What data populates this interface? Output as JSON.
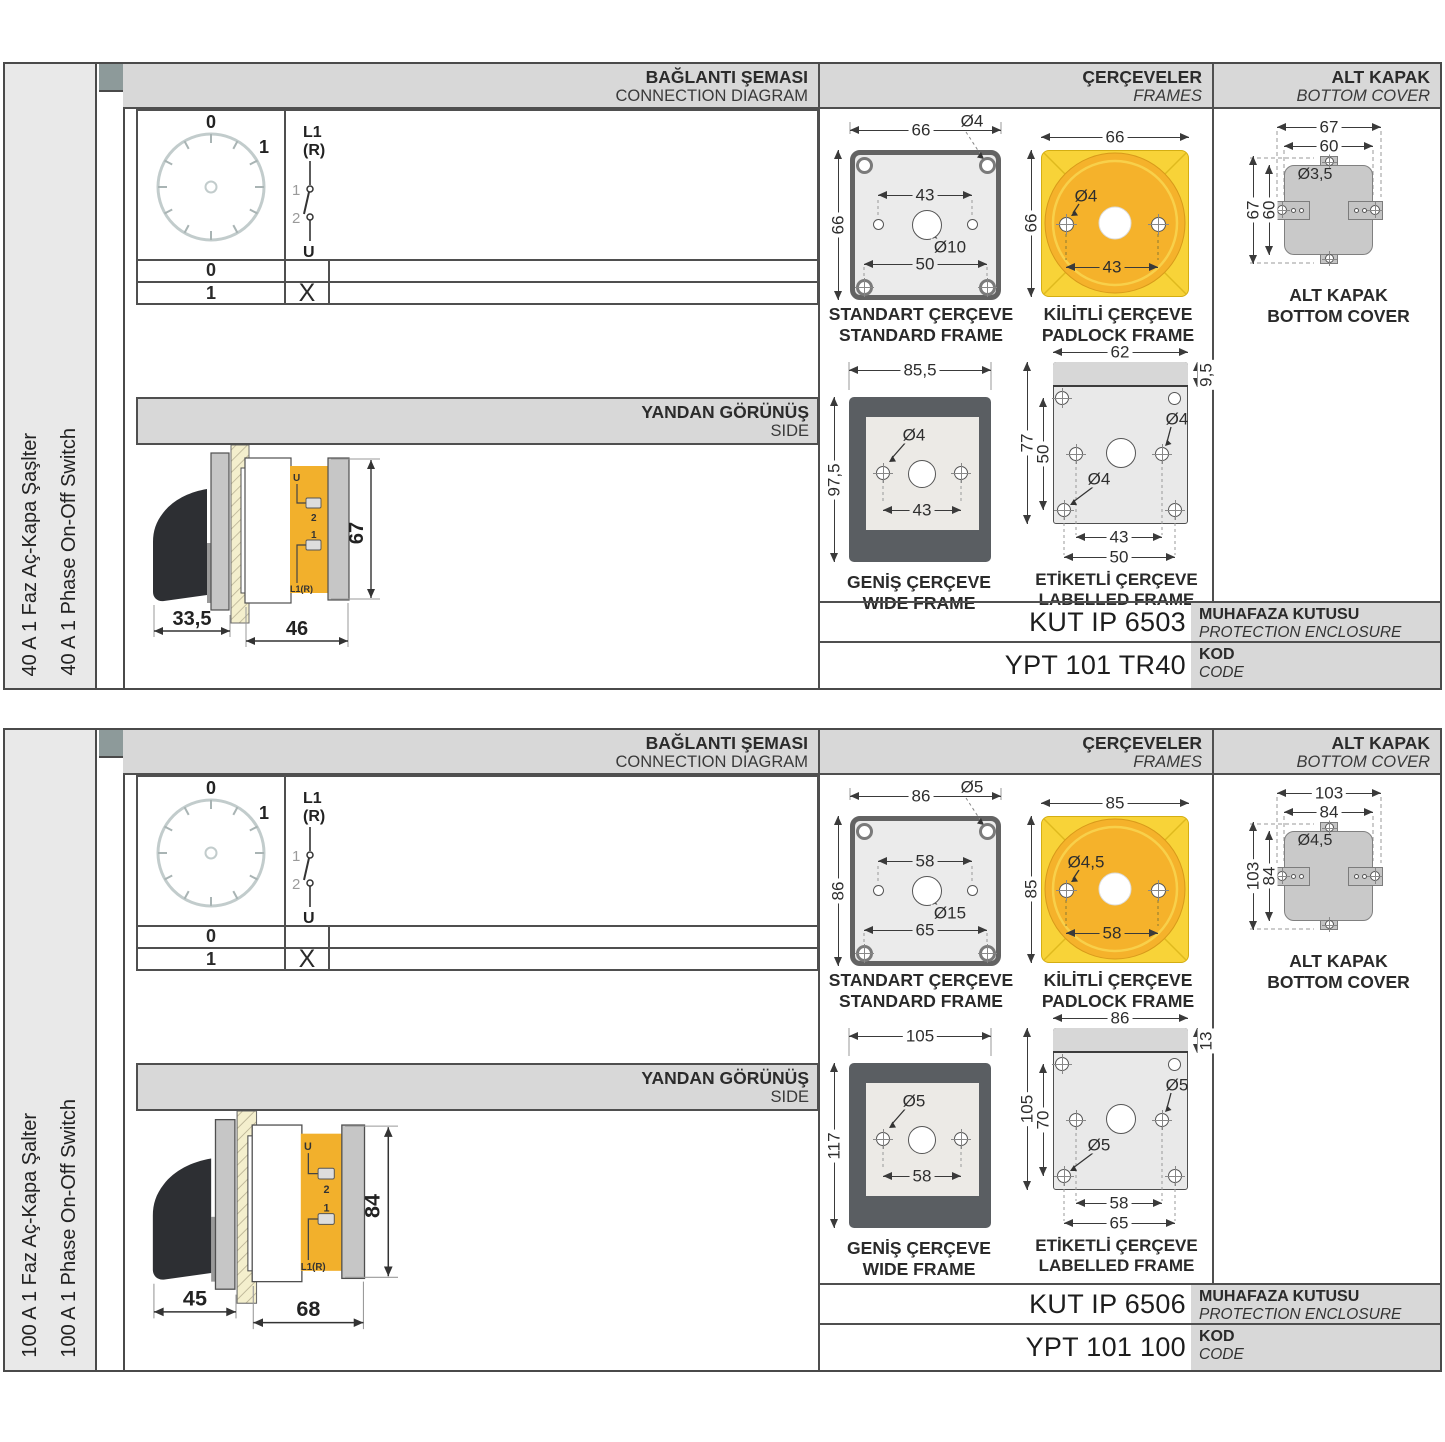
{
  "colors": {
    "accent_yellow": "#f8d338",
    "accent_orange": "#f5b22b",
    "header_gray": "#d8d8d8",
    "frame_dark": "#5a5e62"
  },
  "sections": [
    {
      "side_label_tr": "40 A 1 Faz Aç-Kapa Şaşlter",
      "side_label_en": "40 A 1 Phase On-Off Switch",
      "hdr": {
        "conn_tr": "BAĞLANTI ŞEMASI",
        "conn_en": "CONNECTION DIAGRAM",
        "frames_tr": "ÇERÇEVELER",
        "frames_en": "FRAMES",
        "cover_tr": "ALT KAPAK",
        "cover_en": "BOTTOM COVER",
        "side_tr": "YANDAN GÖRÜNÜŞ",
        "side_en": "SIDE"
      },
      "dial": {
        "pos0": "0",
        "pos1": "1"
      },
      "sw": {
        "l1": "L1",
        "r": "(R)",
        "t1": "1",
        "t2": "2",
        "u": "U"
      },
      "table": {
        "r0": "0",
        "r0x": "",
        "r1": "1",
        "r1x": "X"
      },
      "sideview": {
        "d_handle": "33,5",
        "d_body": "46",
        "d_height": "67",
        "lu": "U",
        "l2": "2",
        "l1": "1",
        "ll1": "L1(R)"
      },
      "std": {
        "w": "66",
        "h": "66",
        "hole": "Ø4",
        "span": "43",
        "center_hole": "Ø10",
        "bspan": "50",
        "cap_tr": "STANDART ÇERÇEVE",
        "cap_en": "STANDARD FRAME"
      },
      "pad": {
        "w": "66",
        "h": "66",
        "hole": "Ø4",
        "span": "43",
        "cap_tr": "KİLİTLİ ÇERÇEVE",
        "cap_en": "PADLOCK FRAME"
      },
      "wide": {
        "w": "85,5",
        "h": "97,5",
        "hole": "Ø4",
        "span": "43",
        "cap_tr": "GENİŞ ÇERÇEVE",
        "cap_en": "WIDE FRAME"
      },
      "lab": {
        "w": "62",
        "strip": "9,5",
        "h": "77",
        "ih": "50",
        "hole1": "Ø4",
        "hole2": "Ø4",
        "span1": "43",
        "span2": "50",
        "cap_tr": "ETİKETLİ ÇERÇEVE",
        "cap_en": "LABELLED FRAME"
      },
      "cover": {
        "w1": "67",
        "w2": "60",
        "h1": "67",
        "h2": "60",
        "hole": "Ø3,5",
        "cap_tr": "ALT KAPAK",
        "cap_en": "BOTTOM COVER"
      },
      "codes": {
        "enc": "KUT IP 6503",
        "enc_tr": "MUHAFAZA KUTUSU",
        "enc_en": "PROTECTION ENCLOSURE",
        "code": "YPT 101 TR40",
        "code_tr": "KOD",
        "code_en": "CODE"
      }
    },
    {
      "side_label_tr": "100 A 1 Faz Aç-Kapa Şalter",
      "side_label_en": "100 A 1 Phase On-Off Switch",
      "hdr": {
        "conn_tr": "BAĞLANTI ŞEMASI",
        "conn_en": "CONNECTION DIAGRAM",
        "frames_tr": "ÇERÇEVELER",
        "frames_en": "FRAMES",
        "cover_tr": "ALT KAPAK",
        "cover_en": "BOTTOM COVER",
        "side_tr": "YANDAN GÖRÜNÜŞ",
        "side_en": "SIDE"
      },
      "dial": {
        "pos0": "0",
        "pos1": "1"
      },
      "sw": {
        "l1": "L1",
        "r": "(R)",
        "t1": "1",
        "t2": "2",
        "u": "U"
      },
      "table": {
        "r0": "0",
        "r0x": "",
        "r1": "1",
        "r1x": "X"
      },
      "sideview": {
        "d_handle": "45",
        "d_body": "68",
        "d_height": "84",
        "lu": "U",
        "l2": "2",
        "l1": "1",
        "ll1": "L1(R)"
      },
      "std": {
        "w": "86",
        "h": "86",
        "hole": "Ø5",
        "span": "58",
        "center_hole": "Ø15",
        "bspan": "65",
        "cap_tr": "STANDART ÇERÇEVE",
        "cap_en": "STANDARD FRAME"
      },
      "pad": {
        "w": "85",
        "h": "85",
        "hole": "Ø4,5",
        "span": "58",
        "cap_tr": "KİLİTLİ ÇERÇEVE",
        "cap_en": "PADLOCK FRAME"
      },
      "wide": {
        "w": "105",
        "h": "117",
        "hole": "Ø5",
        "span": "58",
        "cap_tr": "GENİŞ ÇERÇEVE",
        "cap_en": "WIDE FRAME"
      },
      "lab": {
        "w": "86",
        "strip": "13",
        "h": "105",
        "ih": "70",
        "hole1": "Ø5",
        "hole2": "Ø5",
        "span1": "58",
        "span2": "65",
        "cap_tr": "ETİKETLİ ÇERÇEVE",
        "cap_en": "LABELLED FRAME"
      },
      "cover": {
        "w1": "103",
        "w2": "84",
        "h1": "103",
        "h2": "84",
        "hole": "Ø4,5",
        "cap_tr": "ALT KAPAK",
        "cap_en": "BOTTOM COVER"
      },
      "codes": {
        "enc": "KUT IP 6506",
        "enc_tr": "MUHAFAZA KUTUSU",
        "enc_en": "PROTECTION ENCLOSURE",
        "code": "YPT 101 100",
        "code_tr": "KOD",
        "code_en": "CODE"
      }
    }
  ]
}
